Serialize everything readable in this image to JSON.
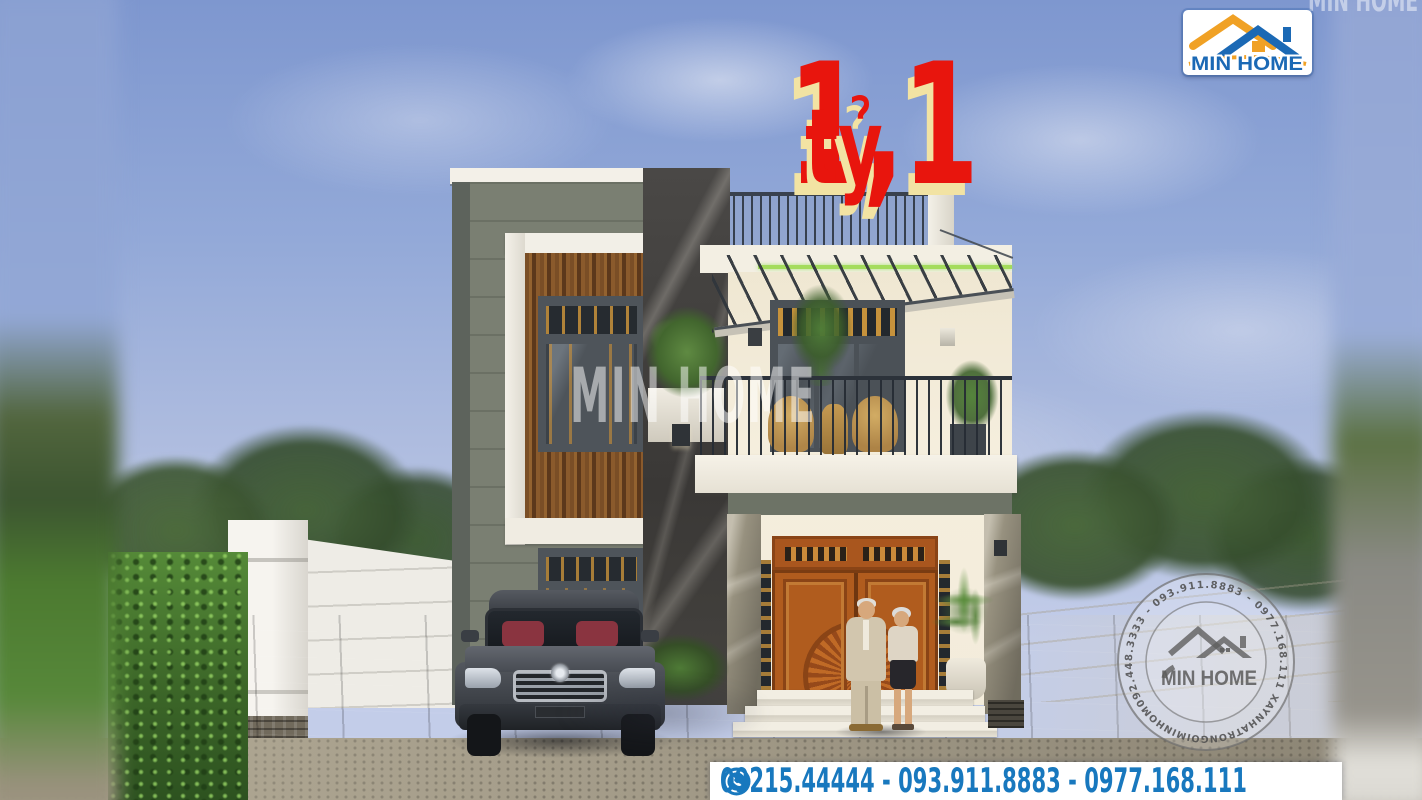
{
  "overlays": {
    "price": {
      "amount": "1,1",
      "unit": "tỷ"
    },
    "center_watermark": "MIN HOME",
    "top_corner_watermark": "MIN HOME",
    "logo": {
      "brand": "MIN HOME"
    },
    "circle_watermark": {
      "brand": "MIN HOME",
      "phones_arc": "092.448.3333 - 093.911.8883 - 0977.168.111",
      "website_arc": "XAYNHATRONGOIMINHOME.VN"
    },
    "contact_bar": {
      "numbers": "09215.44444 - 093.911.8883 - 0977.168.111"
    }
  },
  "colors": {
    "price-red": "#e8150d",
    "price-shadow": "#f2e3a3",
    "brand-blue": "#1b69b5",
    "brand-orange": "#f0a125",
    "contact-blue": "#1878be",
    "led-green": "#a4dc5c",
    "sky-top": "#7e97cf",
    "sky-bottom": "#c3cde9"
  }
}
